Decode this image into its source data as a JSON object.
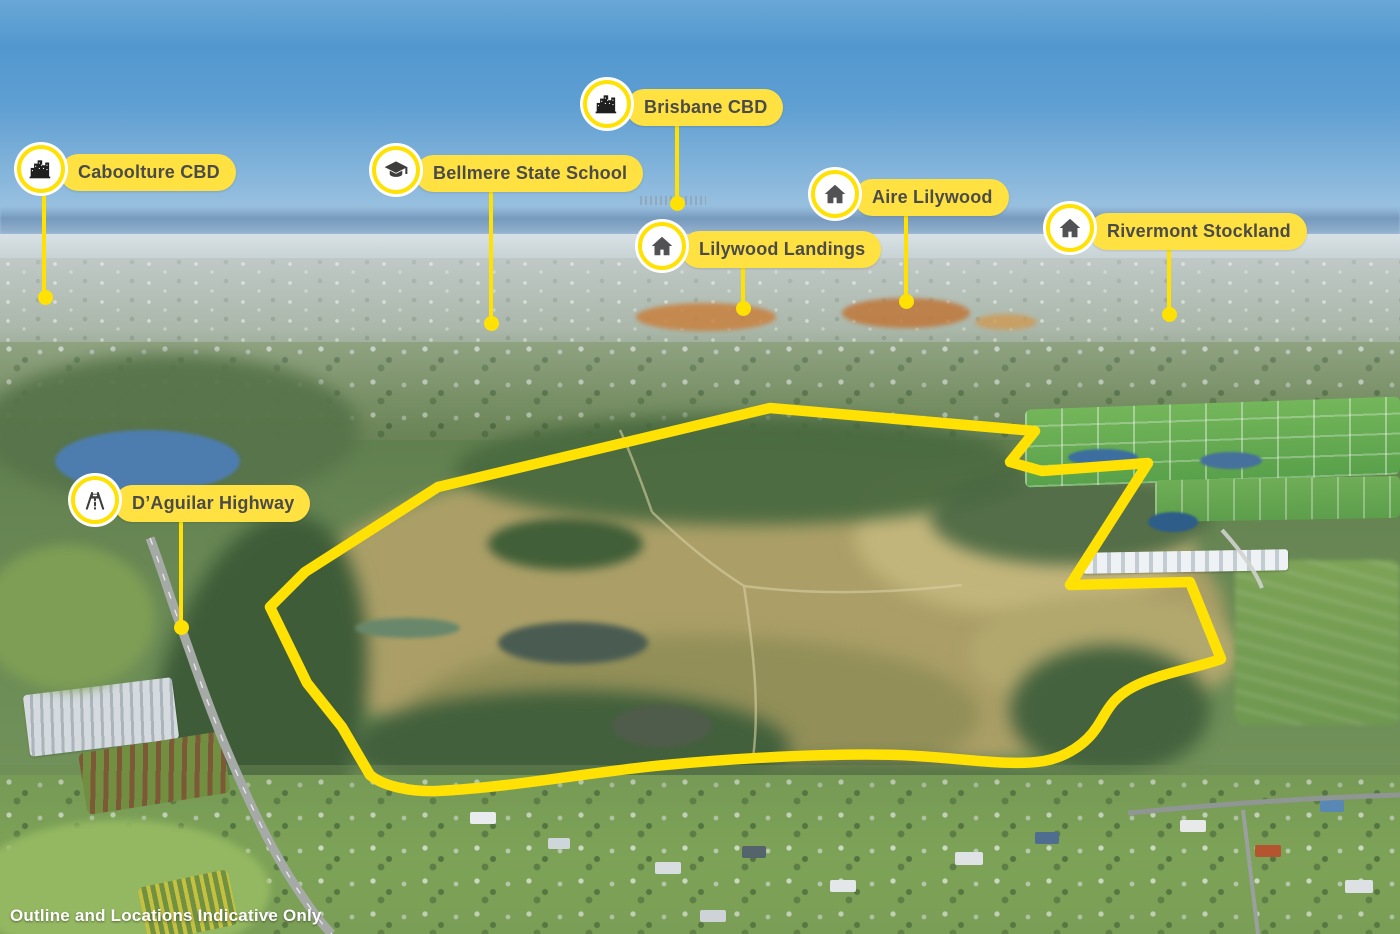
{
  "scene": {
    "description": "Aerial masterplan photo with yellow property outline and location pins",
    "disclaimer": "Outline and Locations Indicative Only"
  },
  "colors": {
    "accent_yellow": "#FFE103",
    "pill_yellow": "#FFE142",
    "pill_text": "#4B4B48",
    "house_icon_gray": "#525254",
    "city_icon_black": "#1F1F1F"
  },
  "boundary": {
    "name": "property-boundary",
    "style": "thick yellow outline, rounded corners"
  },
  "locations": [
    {
      "label": "Caboolture CBD",
      "icon": "city-icon"
    },
    {
      "label": "Bellmere State School",
      "icon": "graduation-cap-icon"
    },
    {
      "label": "Brisbane CBD",
      "icon": "city-icon"
    },
    {
      "label": "Lilywood Landings",
      "icon": "house-icon"
    },
    {
      "label": "Aire Lilywood",
      "icon": "house-icon"
    },
    {
      "label": "Rivermont Stockland",
      "icon": "house-icon"
    },
    {
      "label": "D’Aguilar Highway",
      "icon": "highway-icon"
    }
  ]
}
